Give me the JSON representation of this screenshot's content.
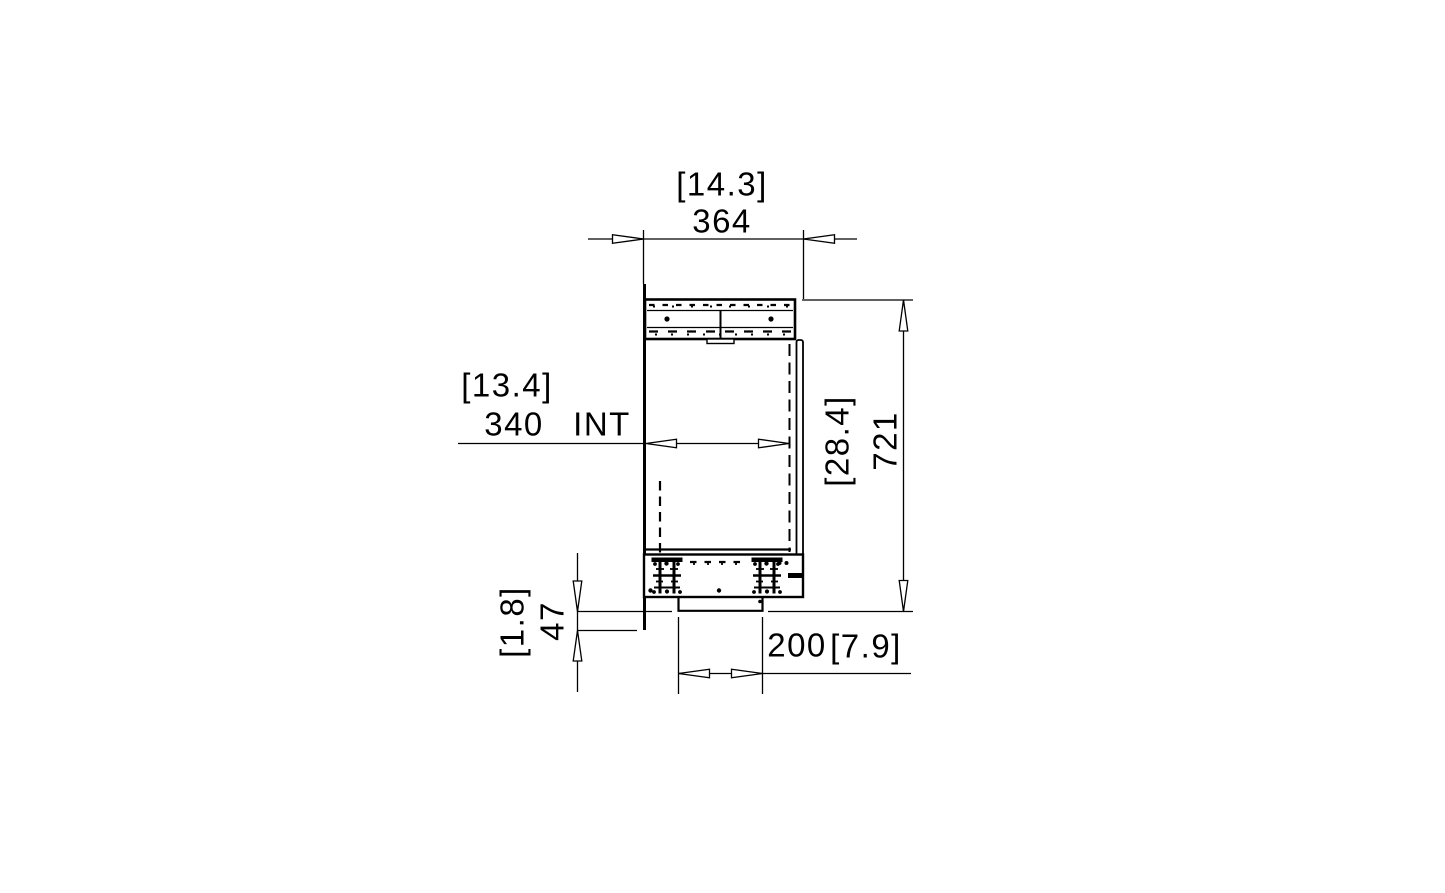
{
  "drawing": {
    "title": "firebox-side-section",
    "line_color": "#000000",
    "background": "#ffffff",
    "dimensions": {
      "overall_width": {
        "imperial": "[14.3]",
        "metric": "364"
      },
      "internal_width": {
        "imperial": "[13.4]",
        "metric": "340",
        "suffix": "INT"
      },
      "overall_height": {
        "imperial": "[28.4]",
        "metric": "721"
      },
      "base_drop": {
        "imperial": "[1.8]",
        "metric": "47"
      },
      "base_width": {
        "metric": "200",
        "imperial": "[7.9]"
      }
    }
  }
}
